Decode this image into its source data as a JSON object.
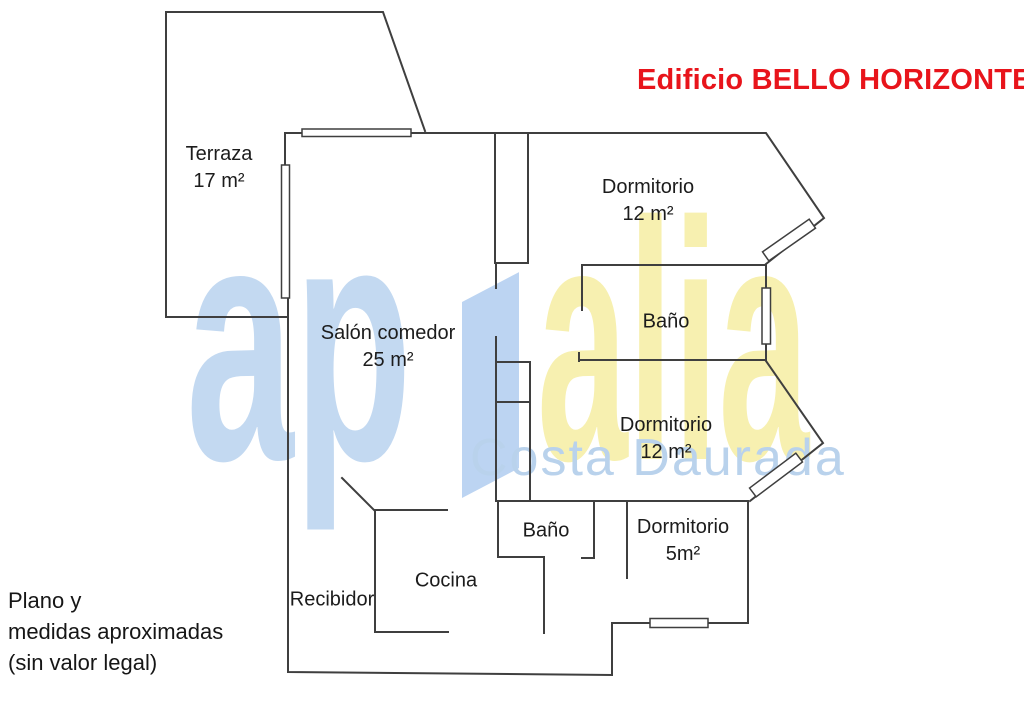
{
  "title": {
    "text": "Edificio BELLO HORIZONTE",
    "color": "#e8141b"
  },
  "watermark": {
    "brand_prefix": "ap",
    "brand_suffix": "alia",
    "subtitle": "Costa Daurada",
    "blue": "#c3d9f1",
    "yellow": "#f7f0b0",
    "subtitle_color": "#b9d2ec"
  },
  "rooms": {
    "terraza": {
      "name": "Terraza",
      "area": "17 m²"
    },
    "salon": {
      "name": "Salón comedor",
      "area": "25 m²"
    },
    "dormitorio_1": {
      "name": "Dormitorio",
      "area": "12 m²"
    },
    "bano_1": {
      "name": "Baño"
    },
    "dormitorio_2": {
      "name": "Dormitorio",
      "area": "12 m²"
    },
    "bano_2": {
      "name": "Baño"
    },
    "dormitorio_3": {
      "name": "Dormitorio",
      "area": "5m²"
    },
    "cocina": {
      "name": "Cocina"
    },
    "recibidor": {
      "name": "Recibidor"
    }
  },
  "disclaimer": {
    "line1": "Plano y",
    "line2": "medidas aproximadas",
    "line3": "(sin valor legal)"
  }
}
